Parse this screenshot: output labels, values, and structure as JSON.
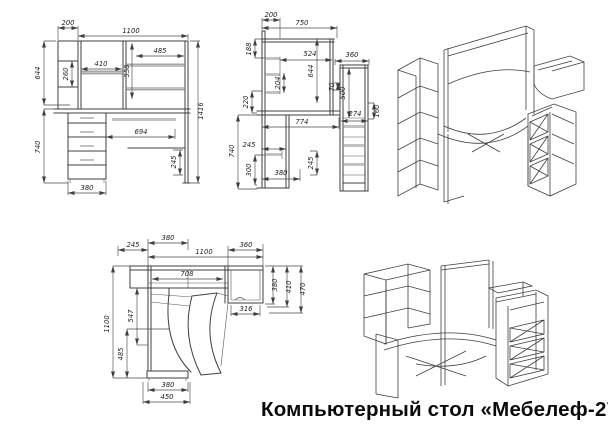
{
  "title": "Компьютерный стол «Мебелеф-27»",
  "colors": {
    "line": "#3f3f3f",
    "dim_text": "#1f1f1f",
    "title_text": "#0a0a0a",
    "background": "#ffffff"
  },
  "views": {
    "front": {
      "dims": [
        "200",
        "1100",
        "485",
        "410",
        "558",
        "644",
        "260",
        "740",
        "694",
        "245",
        "380",
        "1416"
      ]
    },
    "side": {
      "dims": [
        "200",
        "750",
        "188",
        "524",
        "360",
        "204",
        "644",
        "70",
        "500",
        "274",
        "160",
        "220",
        "774",
        "740",
        "245",
        "300",
        "380",
        "245"
      ]
    },
    "plan": {
      "dims": [
        "245",
        "380",
        "1100",
        "360",
        "708",
        "316",
        "380",
        "410",
        "470",
        "547",
        "1100",
        "485",
        "380",
        "450"
      ]
    }
  }
}
